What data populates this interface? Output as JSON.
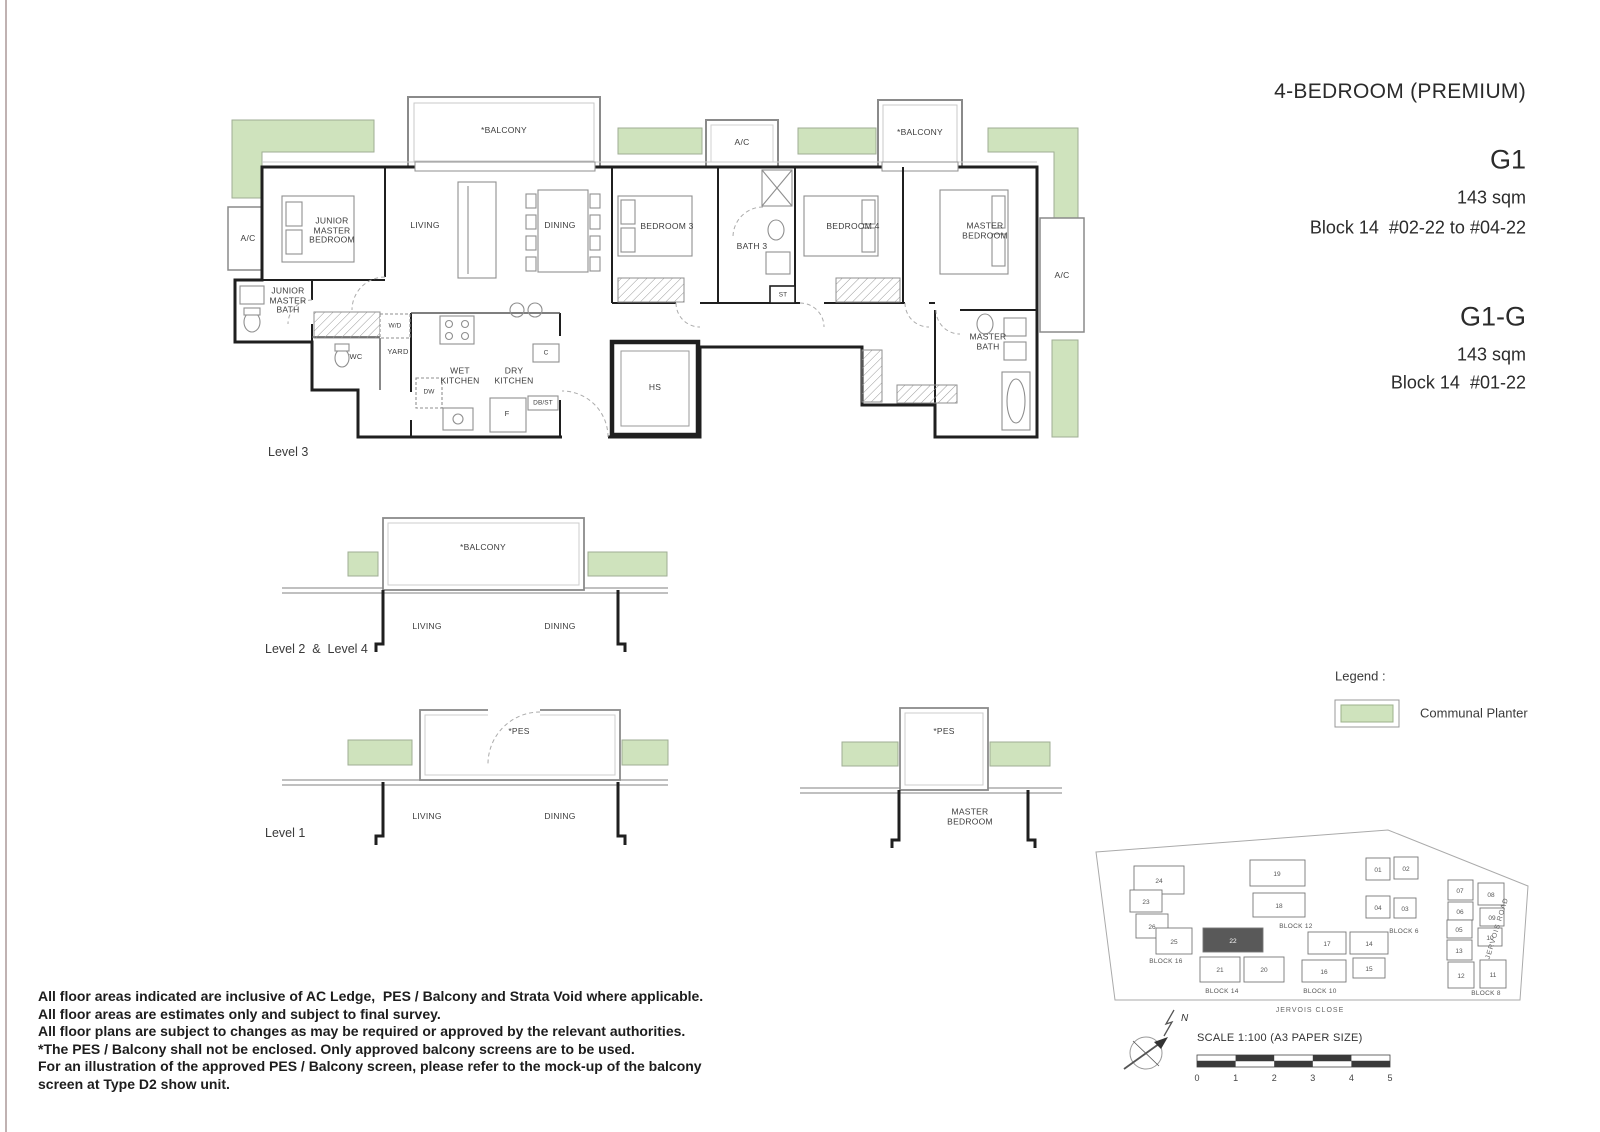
{
  "title_block": {
    "type_label": "4-BEDROOM (PREMIUM)",
    "units": [
      {
        "code": "G1",
        "area": "143 sqm",
        "location": "Block 14  #02-22 to #04-22"
      },
      {
        "code": "G1-G",
        "area": "143 sqm",
        "location": "Block 14  #01-22"
      }
    ]
  },
  "plans": {
    "level3": {
      "caption": "Level 3",
      "labels": {
        "balcony_left": "*BALCONY",
        "balcony_right": "*BALCONY",
        "ac_top": "A/C",
        "ac_left": "A/C",
        "ac_right": "A/C",
        "junior_master_bedroom": "JUNIOR MASTER BEDROOM",
        "living": "LIVING",
        "dining": "DINING",
        "bedroom3": "BEDROOM 3",
        "bath3": "BATH 3",
        "st": "ST",
        "bedroom4": "BEDROOM 4",
        "master_bedroom": "MASTER BEDROOM",
        "junior_master_bath": "JUNIOR MASTER BATH",
        "wd": "W/D",
        "wc": "WC",
        "yard": "YARD",
        "wet_kitchen": "WET KITCHEN",
        "dry_kitchen": "DRY KITCHEN",
        "dw": "DW",
        "fridge": "F",
        "dbst": "DB/ST",
        "counter": "C",
        "hs": "HS",
        "master_bath": "MASTER BATH"
      }
    },
    "level2_4": {
      "caption": "Level 2  &  Level 4",
      "labels": {
        "balcony": "*BALCONY",
        "living": "LIVING",
        "dining": "DINING"
      }
    },
    "level1": {
      "caption": "Level 1",
      "labels": {
        "pes": "*PES",
        "living": "LIVING",
        "dining": "DINING"
      }
    },
    "level1_master": {
      "labels": {
        "pes": "*PES",
        "master_bedroom": "MASTER BEDROOM"
      }
    }
  },
  "legend": {
    "title": "Legend :",
    "items": [
      {
        "label": "Communal Planter",
        "color": "#cfe3bd"
      }
    ]
  },
  "site_plan": {
    "highlighted_unit": "22",
    "roads": {
      "bottom": "JERVOIS CLOSE",
      "right": "JERVOIS ROAD"
    },
    "blocks": [
      {
        "label": "BLOCK 16",
        "units": [
          "24",
          "23",
          "26",
          "25"
        ]
      },
      {
        "label": "BLOCK 12",
        "units": [
          "19",
          "18"
        ]
      },
      {
        "label": "BLOCK 14",
        "units": [
          "22",
          "21",
          "20"
        ]
      },
      {
        "label": "BLOCK 10",
        "units": [
          "17",
          "14",
          "16",
          "15"
        ]
      },
      {
        "label": "BLOCK 6",
        "units": [
          "01",
          "02",
          "04",
          "03"
        ]
      },
      {
        "label": "BLOCK 8",
        "units": [
          "07",
          "08",
          "06",
          "05",
          "09",
          "13",
          "10",
          "12",
          "11"
        ]
      }
    ]
  },
  "scale_bar": {
    "label": "SCALE 1:100 (A3 PAPER SIZE)",
    "ticks": [
      "0",
      "1",
      "2",
      "3",
      "4",
      "5"
    ]
  },
  "compass": {
    "north": "N"
  },
  "notes": {
    "lines": [
      "All floor areas indicated are inclusive of AC Ledge,  PES / Balcony and Strata Void where applicable.",
      "All floor areas are estimates only and subject to final survey.",
      "All floor plans are subject to changes as may be required or approved by the relevant authorities.",
      "*The PES / Balcony shall not be enclosed. Only approved balcony screens are to be used.",
      "For an illustration of the approved PES / Balcony screen, please refer to the mock-up of the balcony",
      "screen at Type D2 show unit."
    ]
  },
  "colors": {
    "planter": "#cfe3bd",
    "wall": "#1f1f1f",
    "highlight_unit": "#595959"
  }
}
